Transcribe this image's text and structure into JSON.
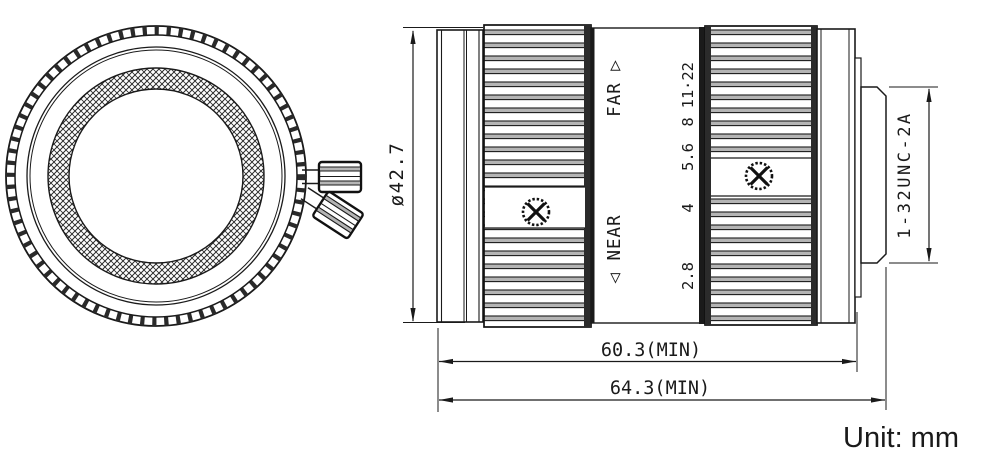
{
  "drawing": {
    "unit_note": "Unit: mm",
    "side_view": {
      "far_label": "FAR ▷",
      "near_label": "◁ NEAR",
      "aperture_scale": [
        "2.8",
        "4",
        "5.6",
        "8",
        "11",
        "·22"
      ],
      "thread_spec": "1-32UNC-2A"
    },
    "dimensions": {
      "outer_diameter": "ø42.7",
      "flange_length_min": "60.3(MIN)",
      "overall_length_min": "64.3(MIN)"
    },
    "colors": {
      "line": "#1a1a1a",
      "knurl_shade": "#b4b4b4",
      "background": "#ffffff"
    }
  }
}
